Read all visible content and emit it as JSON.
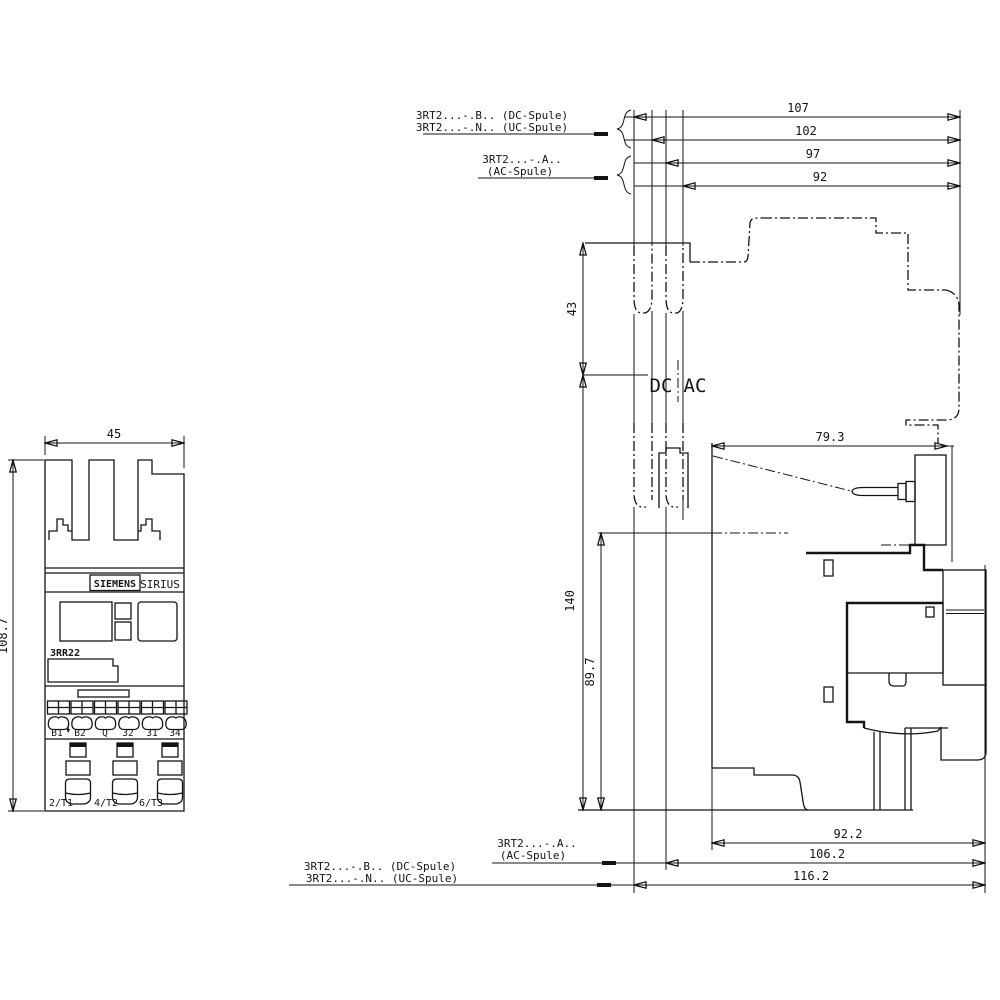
{
  "top_annotations": {
    "leader1_line1": "3RT2...-.B.. (DC-Spule)",
    "leader1_line2": "3RT2...-.N.. (UC-Spule)",
    "leader2_line1": "3RT2...-.A..",
    "leader2_line2": "(AC-Spule)"
  },
  "top_dimensions": {
    "d107": "107",
    "d102": "102",
    "d97": "97",
    "d92": "92"
  },
  "bottom_dimensions": {
    "d92_2": "92.2",
    "d106_2": "106.2",
    "d116_2": "116.2"
  },
  "bottom_annotations": {
    "leader1_line1": "3RT2...-.A..",
    "leader1_line2": "(AC-Spule)",
    "leader2_line1": "3RT2...-.B.. (DC-Spule)",
    "leader2_line2": "3RT2...-.N.. (UC-Spule)"
  },
  "front_view": {
    "width": "45",
    "height": "108.7",
    "brand": "SIEMENS",
    "series": "SIRIUS",
    "model": "3RR22",
    "terminals": [
      "B1",
      "B2",
      "Q",
      "32",
      "31",
      "34"
    ],
    "power_terminals": [
      "2/T1",
      "4/T2",
      "6/T3"
    ]
  },
  "side_view": {
    "coil_left": "DC",
    "coil_right": "AC",
    "dim_top": "43",
    "dim_height": "140",
    "dim_lower": "89.7",
    "dim_depth": "79.3"
  }
}
